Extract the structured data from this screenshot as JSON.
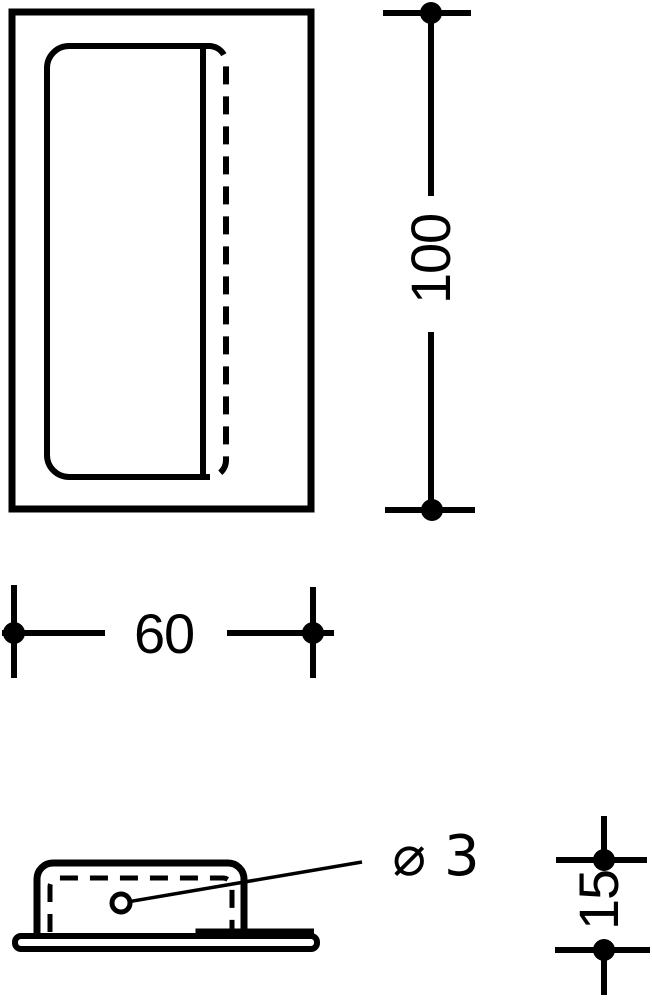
{
  "drawing": {
    "colors": {
      "line": "#000000",
      "background": "#ffffff"
    },
    "labels": {
      "height": "100",
      "width": "60",
      "thickness": "15",
      "hole_diameter": "⌀ 3"
    }
  }
}
